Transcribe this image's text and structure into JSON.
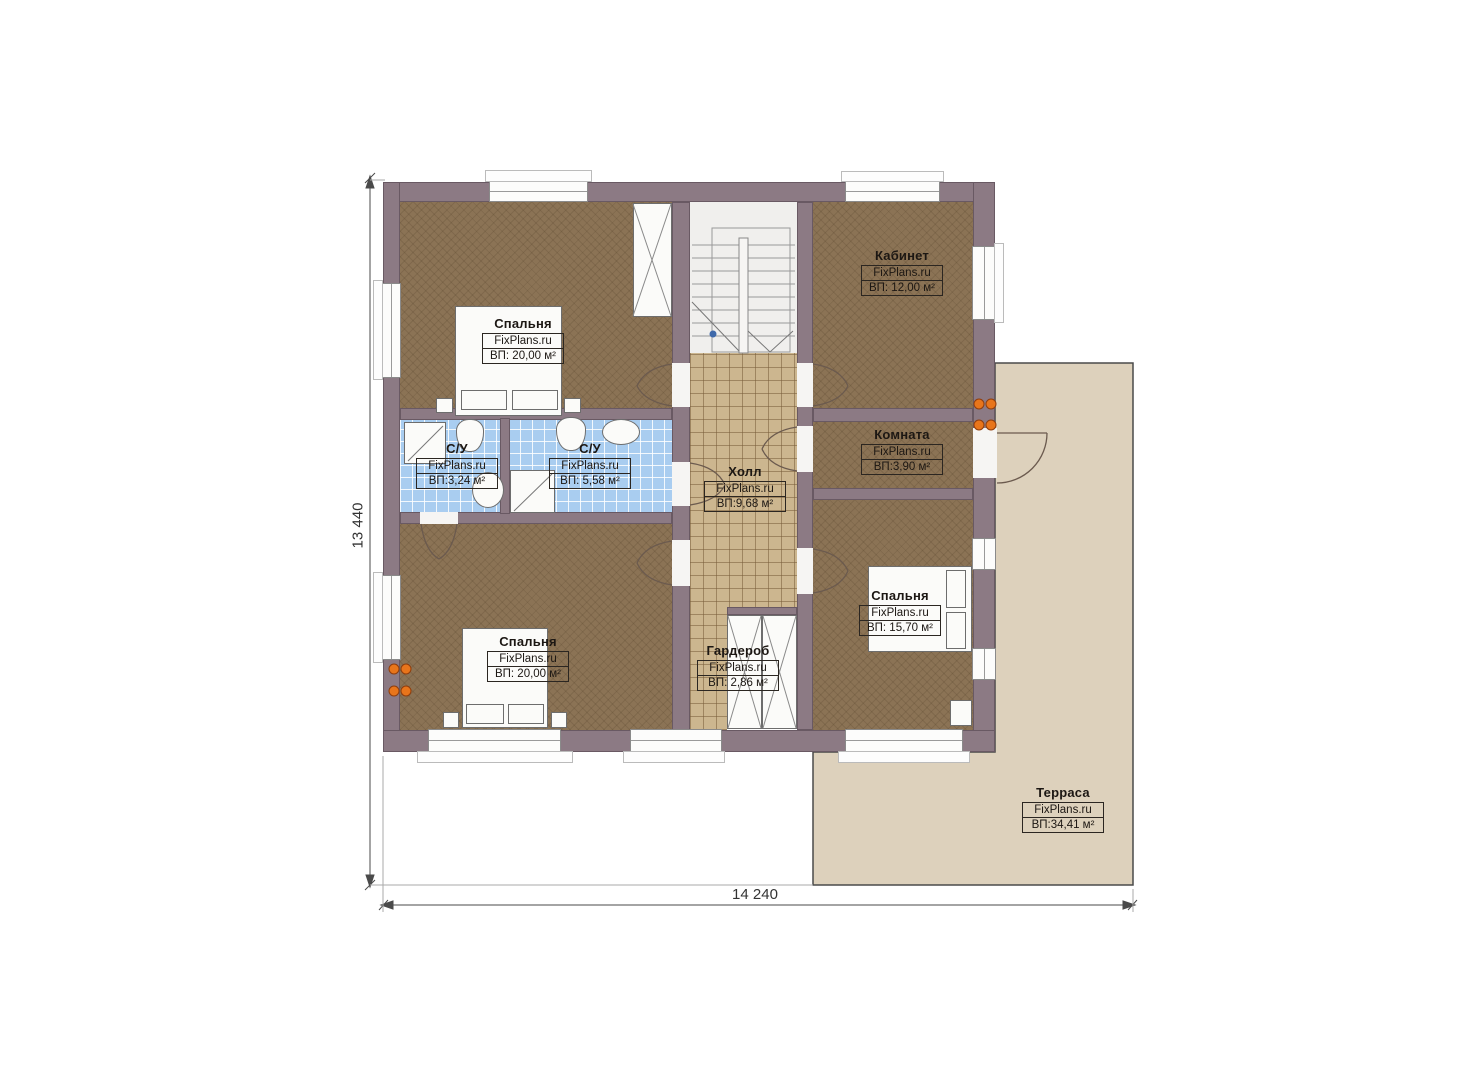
{
  "watermark": "FixPlans.ru",
  "rooms": {
    "bedroom_tl": {
      "name": "Спальня",
      "area": "ВП: 20,00 м²"
    },
    "office": {
      "name": "Кабинет",
      "area": "ВП: 12,00 м²"
    },
    "small_room": {
      "name": "Комната",
      "area": "ВП:3,90 м²"
    },
    "hall": {
      "name": "Холл",
      "area": "ВП:9,68 м²"
    },
    "bath_small": {
      "name": "С/У",
      "area": "ВП:3,24 м²"
    },
    "bath_large": {
      "name": "С/У",
      "area": "ВП: 5,58 м²"
    },
    "bedroom_bl": {
      "name": "Спальня",
      "area": "ВП: 20,00 м²"
    },
    "wardrobe": {
      "name": "Гардероб",
      "area": "ВП: 2,86 м²"
    },
    "bedroom_br": {
      "name": "Спальня",
      "area": "ВП: 15,70 м²"
    },
    "terrace": {
      "name": "Терраса",
      "area": "ВП:34,41 м²"
    }
  },
  "dimensions": {
    "height_label": "13 440",
    "width_label": "14 240"
  },
  "colors": {
    "wall": "#8c7a84",
    "floor_wood": "#8b7355",
    "floor_tile_hall": "#ccb68f",
    "floor_tile_bath": "#a9cdf0",
    "terrace": "#ddd1bc",
    "radiator": "#e8751b",
    "stairs_bg": "#f0efed"
  }
}
